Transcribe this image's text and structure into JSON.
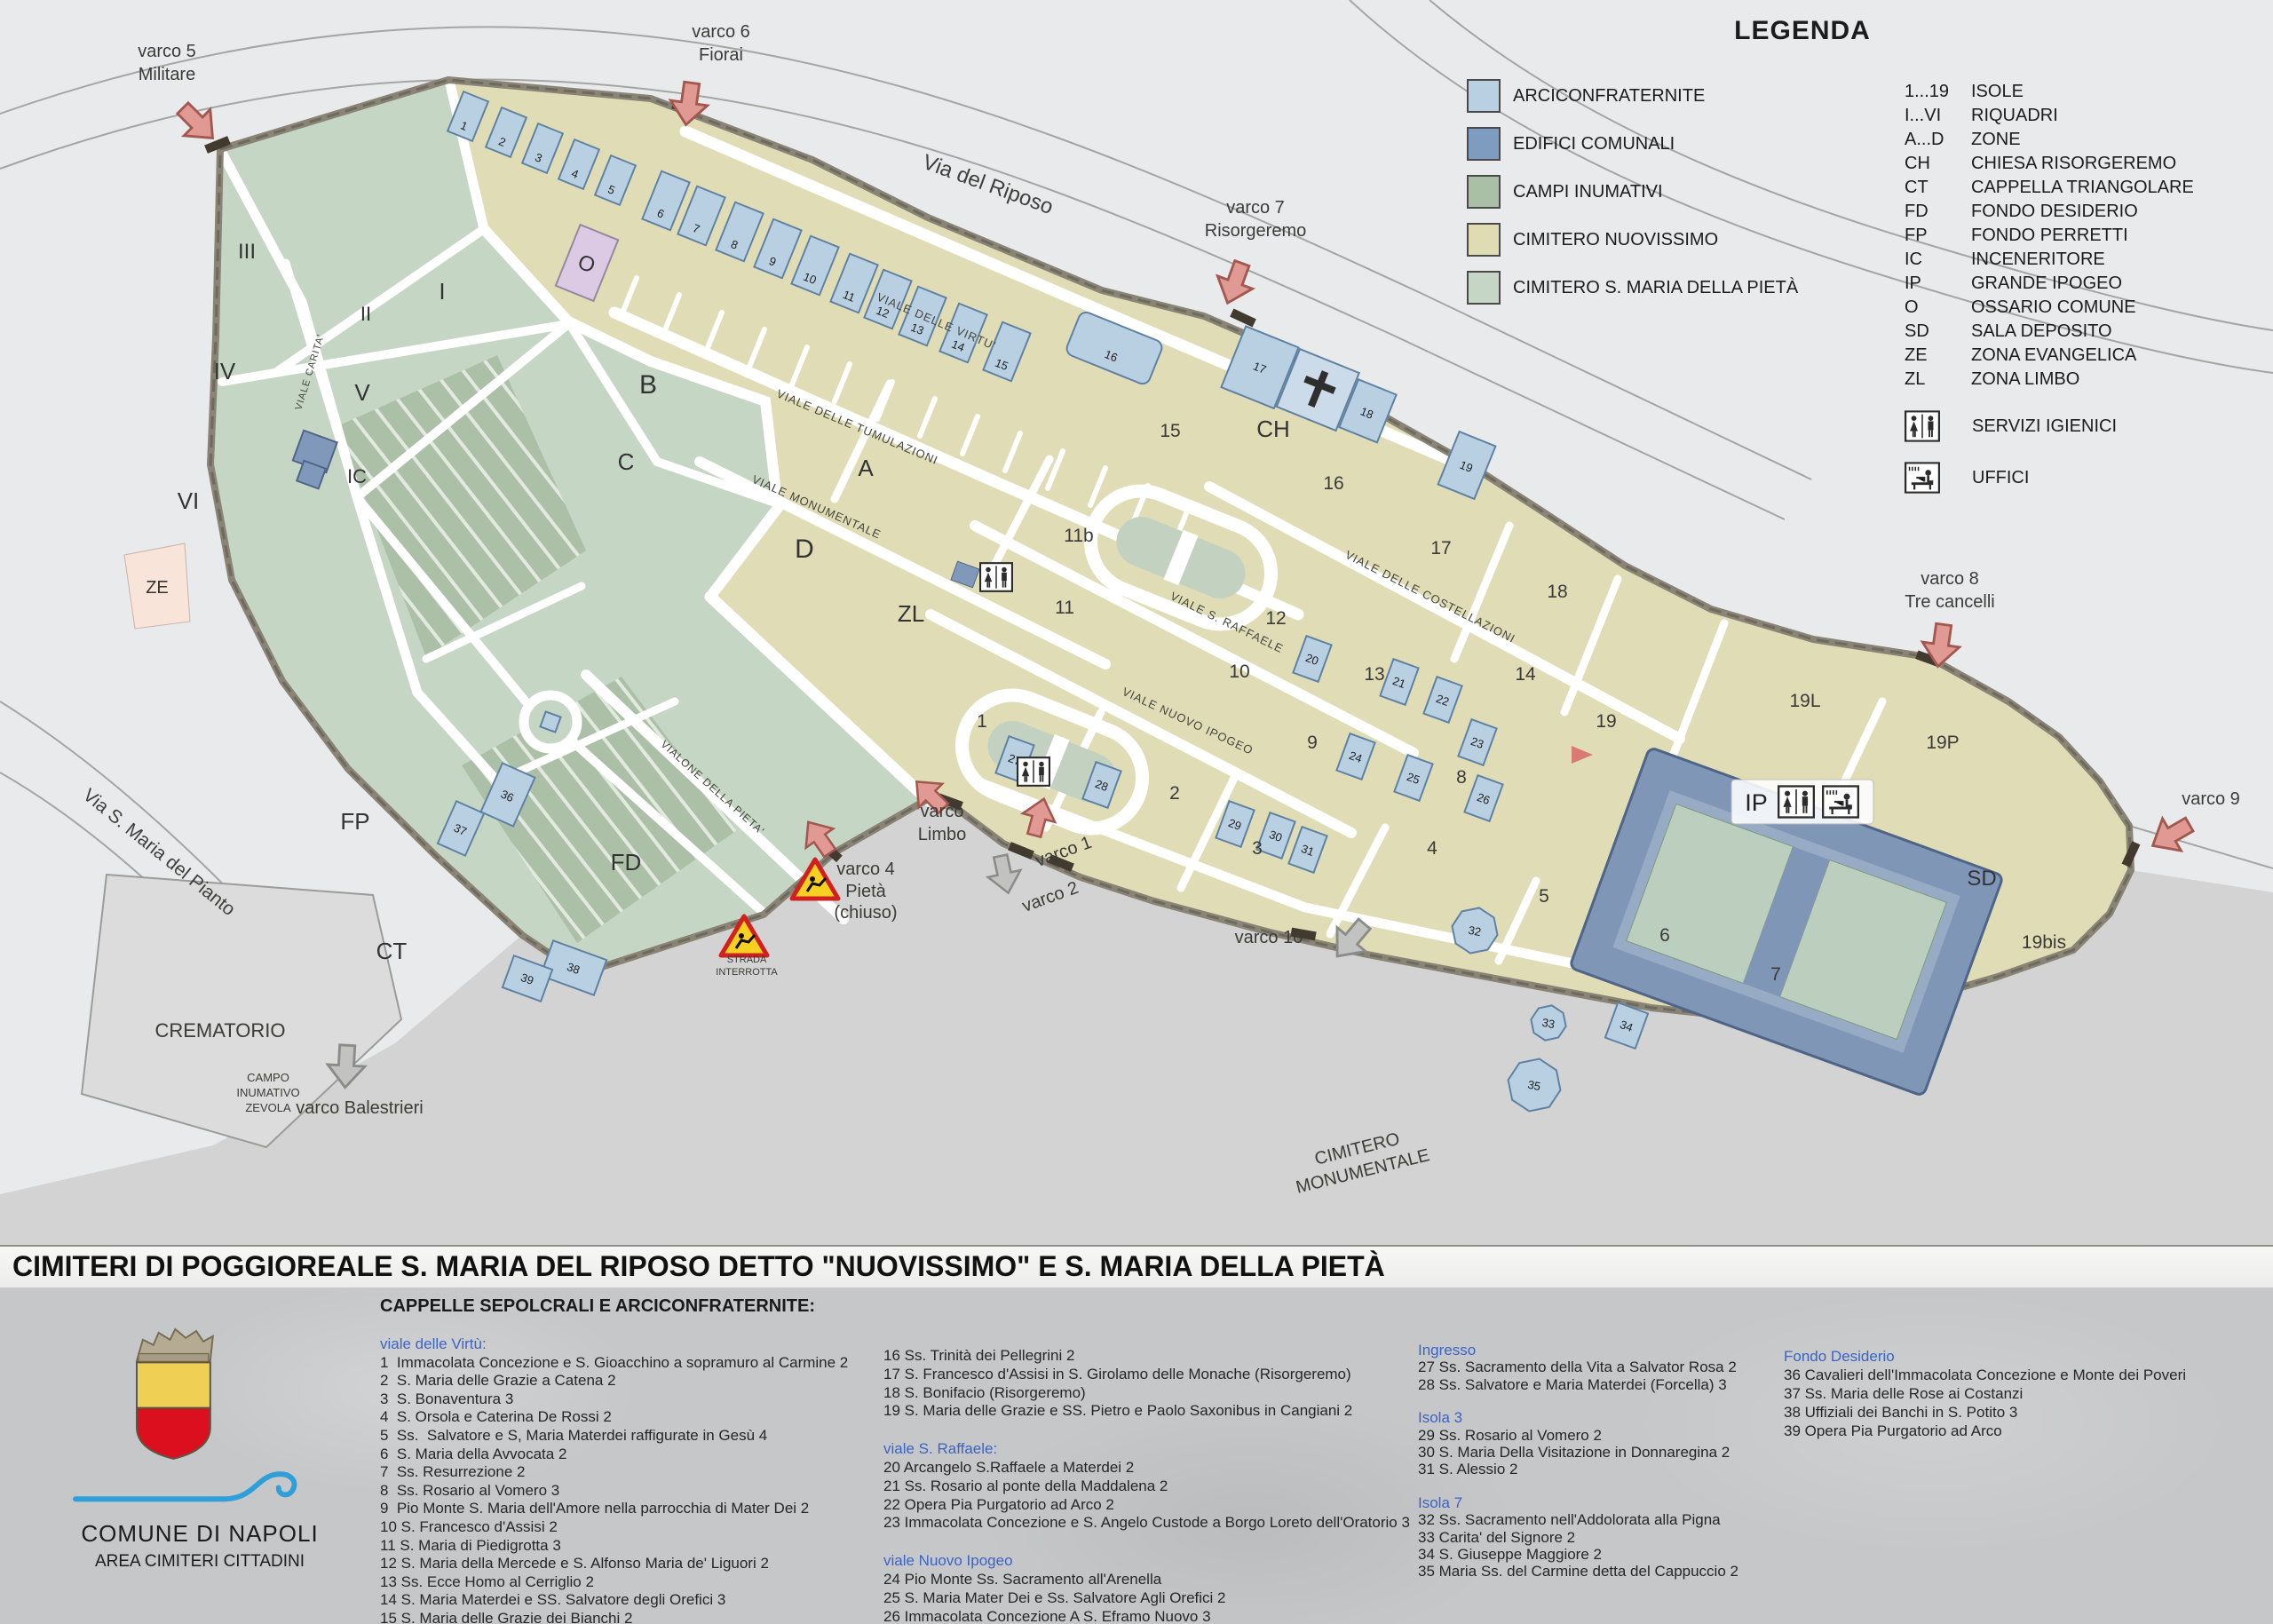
{
  "legend": {
    "title": "LEGENDA",
    "swatches": [
      {
        "label": "ARCICONFRATERNITE",
        "color": "#b9d0e2"
      },
      {
        "label": "EDIFICI COMUNALI",
        "color": "#7e9cc0"
      },
      {
        "label": "CAMPI INUMATIVI",
        "color": "#a9c0a6"
      },
      {
        "label": "CIMITERO NUOVISSIMO",
        "color": "#dfdcb4"
      },
      {
        "label": "CIMITERO S. MARIA DELLA PIETÀ",
        "color": "#c6d6c6"
      }
    ],
    "codes": [
      {
        "code": "1...19",
        "label": "ISOLE"
      },
      {
        "code": "I...VI",
        "label": "RIQUADRI"
      },
      {
        "code": "A...D",
        "label": "ZONE"
      },
      {
        "code": "CH",
        "label": "CHIESA RISORGEREMO"
      },
      {
        "code": "CT",
        "label": "CAPPELLA TRIANGOLARE"
      },
      {
        "code": "FD",
        "label": "FONDO DESIDERIO"
      },
      {
        "code": "FP",
        "label": "FONDO PERRETTI"
      },
      {
        "code": "IC",
        "label": "INCENERITORE"
      },
      {
        "code": "IP",
        "label": "GRANDE IPOGEO"
      },
      {
        "code": "O",
        "label": "OSSARIO COMUNE"
      },
      {
        "code": "SD",
        "label": "SALA DEPOSITO"
      },
      {
        "code": "ZE",
        "label": "ZONA EVANGELICA"
      },
      {
        "code": "ZL",
        "label": "ZONA LIMBO"
      }
    ],
    "services": [
      {
        "icon": "wc-icon",
        "label": "SERVIZI IGIENICI"
      },
      {
        "icon": "office-icon",
        "label": "UFFICI"
      }
    ]
  },
  "map": {
    "gates": {
      "varco5": [
        "varco 5",
        "Militare"
      ],
      "varco6": [
        "varco 6",
        "Fiorai"
      ],
      "varco7": [
        "varco 7",
        "Risorgeremo"
      ],
      "varco8": [
        "varco 8",
        "Tre cancelli"
      ],
      "varco9": "varco 9",
      "varco10": "varco 10",
      "varco1": "varco 1",
      "varco2": "varco 2",
      "limbo": [
        "varco",
        "Limbo"
      ],
      "varco4": [
        "varco 4",
        "Pietà",
        "(chiuso)"
      ],
      "balestrieri": "varco Balestrieri"
    },
    "warning": [
      "STRADA",
      "INTERROTTA"
    ],
    "streets": {
      "riposo": "Via del Riposo",
      "pianto": "Via S. Maria del Pianto",
      "virtu": "VIALE DELLE VIRTU'",
      "tumulazioni": "VIALE DELLE TUMULAZIONI",
      "monumentale": "VIALE MONUMENTALE",
      "carita": "VIALE CARITA'",
      "raffaele": "VIALE S. RAFFAELE",
      "nuovo_ipogeo": "VIALE NUOVO IPOGEO",
      "costellazioni": "VIALE DELLE COSTELLAZIONI",
      "vialone_pieta": "VIALONE DELLA PIETA'"
    },
    "areas": {
      "crematorio": "CREMATORIO",
      "zevola": [
        "CAMPO",
        "INUMATIVO",
        "ZEVOLA"
      ],
      "cimitero_monumentale": [
        "CIMITERO",
        "MONUMENTALE"
      ]
    },
    "zones": {
      "A": "A",
      "B": "B",
      "C": "C",
      "D": "D",
      "ZL": "ZL",
      "ZE": "ZE",
      "FP": "FP",
      "FD": "FD",
      "CT": "CT",
      "IC": "IC",
      "CH": "CH",
      "O": "O",
      "SD": "SD",
      "IP": "IP"
    },
    "riquadri": {
      "r1": "I",
      "r2": "II",
      "r3": "III",
      "r4": "IV",
      "r5": "V",
      "r6": "VI"
    },
    "isole": {
      "i1": "1",
      "i2": "2",
      "i3": "3",
      "i4": "4",
      "i5": "5",
      "i6": "6",
      "i7": "7",
      "i8": "8",
      "i9": "9",
      "i10": "10",
      "i11": "11",
      "i11b": "11b",
      "i12": "12",
      "i13": "13",
      "i14": "14",
      "i15": "15",
      "i16": "16",
      "i17": "17",
      "i18": "18",
      "i19": "19",
      "i19L": "19L",
      "i19P": "19P",
      "i19bis": "19bis"
    },
    "buildings": {
      "b1": "1",
      "b2": "2",
      "b3": "3",
      "b4": "4",
      "b5": "5",
      "b6": "6",
      "b7": "7",
      "b8": "8",
      "b9": "9",
      "b10": "10",
      "b11": "11",
      "b12": "12",
      "b13": "13",
      "b14": "14",
      "b15": "15",
      "b16": "16",
      "b17": "17",
      "b18": "18",
      "b19": "19",
      "b20": "20",
      "b21": "21",
      "b22": "22",
      "b23": "23",
      "b24": "24",
      "b25": "25",
      "b26": "26",
      "b27": "27",
      "b28": "28",
      "b29": "29",
      "b30": "30",
      "b31": "31",
      "b32": "32",
      "b33": "33",
      "b34": "34",
      "b35": "35",
      "b36": "36",
      "b37": "37",
      "b38": "38",
      "b39": "39"
    }
  },
  "footer": {
    "title": "CIMITERI DI POGGIOREALE S. MARIA DEL RIPOSO DETTO \"NUOVISSIMO\" E S. MARIA DELLA PIETÀ",
    "subtitle": "CAPPELLE SEPOLCRALI E ARCICONFRATERNITE:",
    "accent": "#3b63c6",
    "logo": {
      "name": "COMUNE DI NAPOLI",
      "dept": "AREA CIMITERI CITTADINI"
    },
    "columns": [
      {
        "groups": [
          {
            "header": "viale delle Virtù:",
            "items": [
              "1  Immacolata Concezione e S. Gioacchino a sopramuro al Carmine 2",
              "2  S. Maria delle Grazie a Catena 2",
              "3  S. Bonaventura 3",
              "4  S. Orsola e Caterina De Rossi 2",
              "5  Ss.  Salvatore e S, Maria Materdei raffigurate in Gesù 4",
              "6  S. Maria della Avvocata 2",
              "7  Ss. Resurrezione 2",
              "8  Ss. Rosario al Vomero 3",
              "9  Pio Monte S. Maria dell'Amore nella parrocchia di Mater Dei 2",
              "10 S. Francesco d'Assisi 2",
              "11 S. Maria di Piedigrotta 3",
              "12 S. Maria della Mercede e S. Alfonso Maria de' Liguori 2",
              "13 Ss. Ecce Homo al Cerriglio 2",
              "14 S. Maria Materdei e SS. Salvatore degli Orefici 3",
              "15 S. Maria delle Grazie dei Bianchi 2"
            ]
          }
        ]
      },
      {
        "groups": [
          {
            "header": "",
            "items": [
              "16 Ss. Trinità dei Pellegrini 2",
              "17 S. Francesco d'Assisi in S. Girolamo delle Monache (Risorgeremo)",
              "18 S. Bonifacio (Risorgeremo)",
              "19 S. Maria delle Grazie e SS. Pietro e Paolo Saxonibus in Cangiani 2"
            ]
          },
          {
            "header": "viale S. Raffaele:",
            "items": [
              "20 Arcangelo S.Raffaele a Materdei 2",
              "21 Ss. Rosario al ponte della Maddalena 2",
              "22 Opera Pia Purgatorio ad Arco 2",
              "23 Immacolata Concezione e S. Angelo Custode a Borgo Loreto dell'Oratorio 3"
            ]
          },
          {
            "header": "viale Nuovo Ipogeo",
            "items": [
              "24 Pio Monte Ss. Sacramento all'Arenella",
              "25 S. Maria Mater Dei e Ss. Salvatore Agli Orefici 2",
              "26 Immacolata Concezione A S. Eframo Nuovo 3"
            ]
          }
        ]
      },
      {
        "groups": [
          {
            "header": "Ingresso",
            "items": [
              "27 Ss. Sacramento della Vita a Salvator Rosa 2",
              "28 Ss. Salvatore e Maria Materdei (Forcella) 3"
            ]
          },
          {
            "header": "Isola 3",
            "items": [
              "29 Ss. Rosario al Vomero 2",
              "30 S. Maria Della Visitazione in Donnaregina 2",
              "31 S. Alessio 2"
            ]
          },
          {
            "header": "Isola 7",
            "items": [
              "32 Ss. Sacramento nell'Addolorata alla Pigna",
              "33 Carita' del Signore 2",
              "34 S. Giuseppe Maggiore 2",
              "35 Maria Ss. del Carmine detta del Cappuccio 2"
            ]
          }
        ]
      },
      {
        "groups": [
          {
            "header": "Fondo Desiderio",
            "items": [
              "36 Cavalieri dell'Immacolata Concezione e Monte dei Poveri",
              "37 Ss. Maria delle Rose ai Costanzi",
              "38 Uffiziali dei Banchi in S. Potito 3",
              "39 Opera Pia Purgatorio ad Arco"
            ]
          }
        ]
      }
    ]
  }
}
